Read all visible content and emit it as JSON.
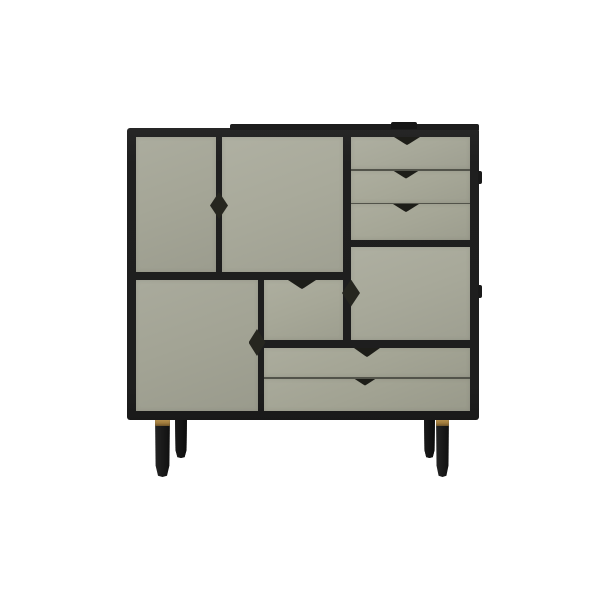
{
  "meta": {
    "type": "product-photo",
    "subject": "modular sideboard cabinet with black frame, grey-green doors and drawers, black tapered wooden legs with brass rings",
    "visible_text": ""
  },
  "colors": {
    "background": "#ffffff",
    "frame": "#1f1f1f",
    "handle": "#26261f",
    "seam": "#5c5d52",
    "brass": "#c09a55",
    "leg_front": "#1b1b1b",
    "leg_rear": "#131313",
    "panels": {
      "door_tl": "#a5a697",
      "door_tm": "#a9aa9b",
      "drawer_r1": "#a8a99a",
      "drawer_r2": "#a7a898",
      "drawer_r3": "#a6a797",
      "door_r": "#a8a99a",
      "door_bl": "#a3a495",
      "door_mid": "#a7a898",
      "drawer_w1": "#a5a696",
      "drawer_w2": "#a2a393"
    }
  },
  "cabinet": {
    "front_panels": [
      {
        "id": "door-top-left",
        "kind": "door",
        "handle": "diamond-on-right-edge"
      },
      {
        "id": "door-top-middle",
        "kind": "door",
        "handle": "shared-diamond-on-left-edge"
      },
      {
        "id": "drawer-right-1",
        "kind": "drawer",
        "handle": "triangle-notch-top-center"
      },
      {
        "id": "drawer-right-2",
        "kind": "drawer",
        "handle": "triangle-notch-top-center"
      },
      {
        "id": "drawer-right-3",
        "kind": "drawer",
        "handle": "triangle-notch-top-center"
      },
      {
        "id": "door-right",
        "kind": "door",
        "handle": "diamond-on-left-edge"
      },
      {
        "id": "door-bottom-left",
        "kind": "door",
        "handle": "diamond-on-right-edge"
      },
      {
        "id": "door-middle",
        "kind": "door",
        "handle": "triangle-notch-top-center"
      },
      {
        "id": "drawer-wide-1",
        "kind": "drawer",
        "handle": "triangle-notch-top-center"
      },
      {
        "id": "drawer-wide-2",
        "kind": "drawer",
        "handle": "triangle-notch-top-center"
      }
    ],
    "legs": [
      {
        "id": "front-left",
        "accent": "brass-ring"
      },
      {
        "id": "rear-left",
        "accent": "none-visible"
      },
      {
        "id": "rear-right",
        "accent": "none-visible"
      },
      {
        "id": "front-right",
        "accent": "brass-ring"
      }
    ]
  }
}
